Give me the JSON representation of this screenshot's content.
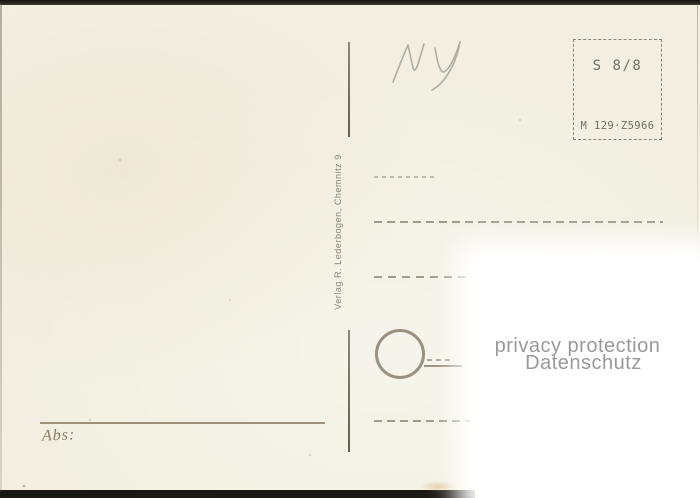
{
  "card": {
    "kind_label": "postcard back (blank, undivided address side)"
  },
  "publisher": {
    "imprint": "Verlag R. Lederbogen, Chemnitz 9"
  },
  "stamp_box": {
    "value_code": "S 8/8",
    "catalog_code": "M 129·Z5966"
  },
  "handwriting": {
    "initials": "MV"
  },
  "sender": {
    "label": "Abs:"
  },
  "watermark": {
    "line1": "privacy protection",
    "line2": "Datenschutz"
  },
  "colors": {
    "card_cream": "#f2efe2",
    "print_ink": "#8d8374",
    "stamp_ink": "#776d5f",
    "scan_edge_dark": "#1a1813",
    "pencil_gray": "#a6a095",
    "watermark_gray": "#8f8f8f",
    "overlay_white": "#ffffff"
  }
}
